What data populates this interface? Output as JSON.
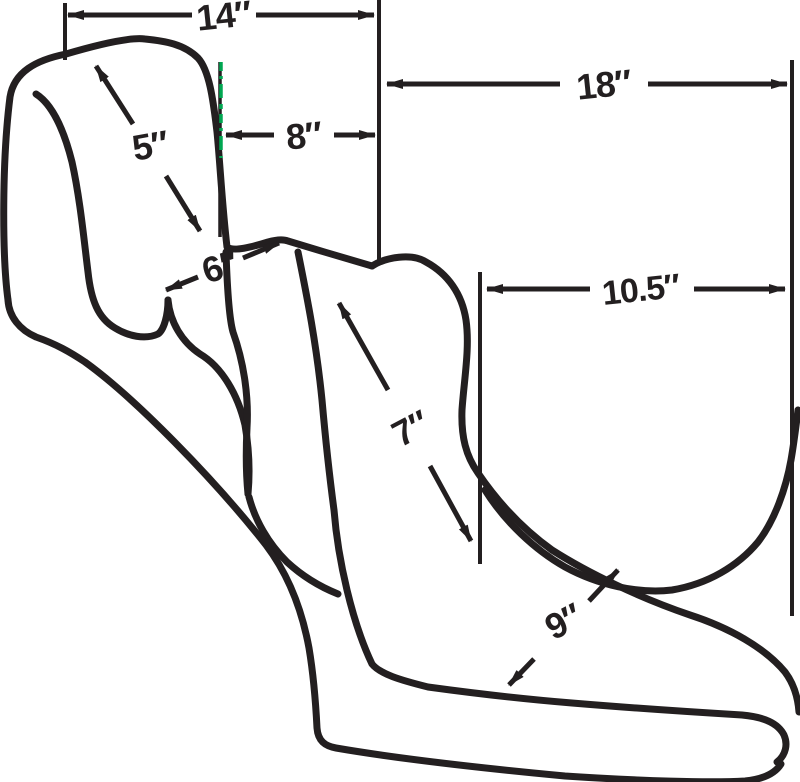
{
  "diagram": {
    "type": "motorcycle-seat-dimension-diagram",
    "colors": {
      "ink": "#231F20",
      "datum_green": "#00A651",
      "background": "#FFFFFF"
    },
    "dimensions": {
      "d14": {
        "label": "14″"
      },
      "d18": {
        "label": "18″"
      },
      "d8": {
        "label": "8″"
      },
      "d5": {
        "label": "5″"
      },
      "d6": {
        "label": "6″"
      },
      "d105": {
        "label": "10.5″"
      },
      "d7": {
        "label": "7″"
      },
      "d9": {
        "label": "9″"
      }
    }
  }
}
